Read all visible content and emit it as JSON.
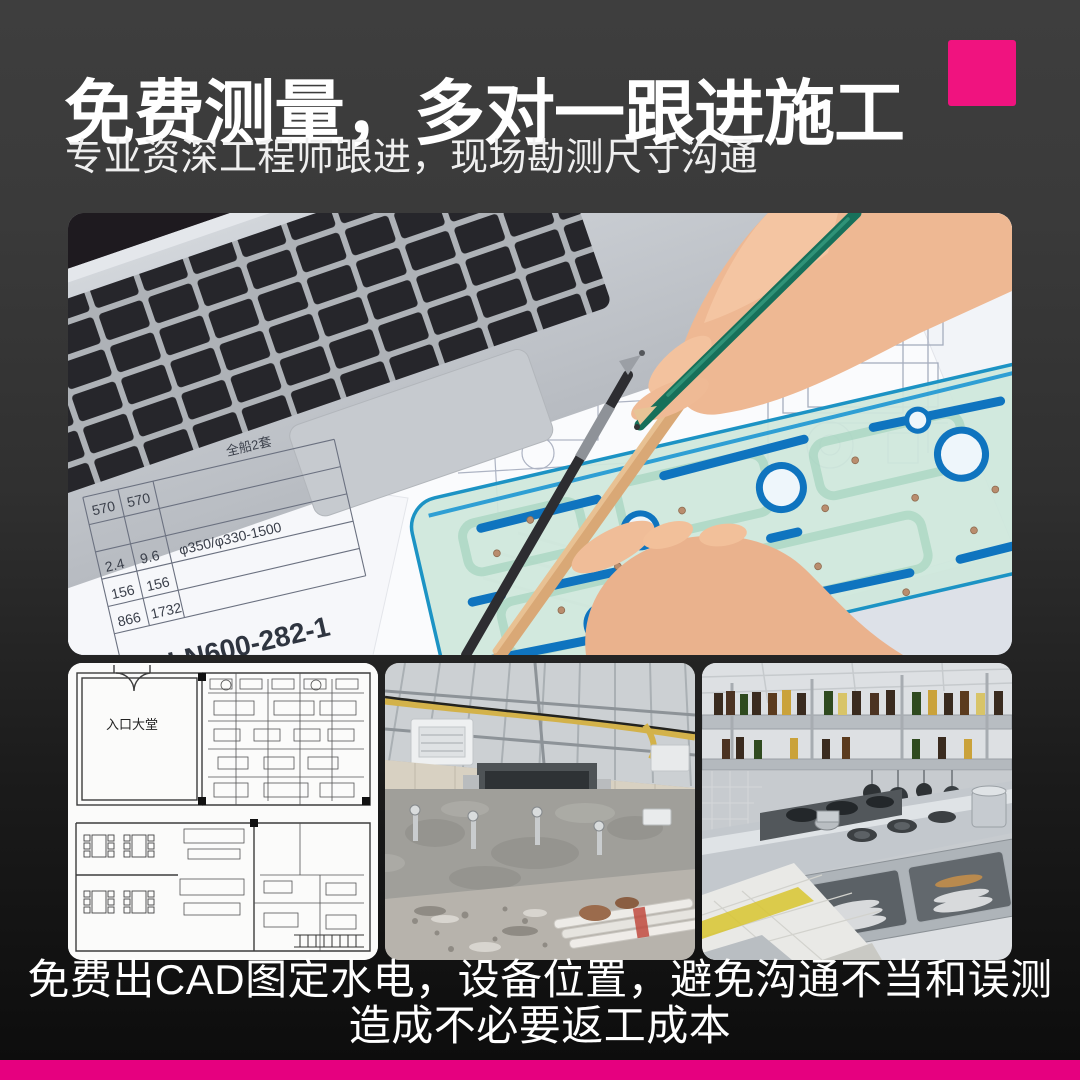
{
  "colors": {
    "accent_square": "#F0137F",
    "bottom_bar": "#E6007F",
    "bg_top": "#3E3E3E",
    "bg_bottom": "#0C0C0C",
    "headline_text": "#FFFFFF"
  },
  "header": {
    "title": "免费测量，多对一跟进施工",
    "subtitle": "专业资深工程师跟进，现场勘测尺寸沟通"
  },
  "hero_photo_text": {
    "sheet_note": "全船2套",
    "dim_rows": [
      [
        "570",
        "570"
      ],
      [
        "2.4",
        "9.6"
      ],
      [
        "156",
        "156"
      ],
      [
        "866",
        "1732"
      ]
    ],
    "spec": "φ350/φ330-1500",
    "part_no": "DLN600-282-1",
    "system_note": "系统",
    "machine_note": "6000M3扒渣机"
  },
  "gallery": {
    "floorplan_label": "入口大堂"
  },
  "footer": {
    "line1": "免费出CAD图定水电，设备位置，避免沟通不当和误测",
    "line2": "造成不必要返工成本"
  }
}
